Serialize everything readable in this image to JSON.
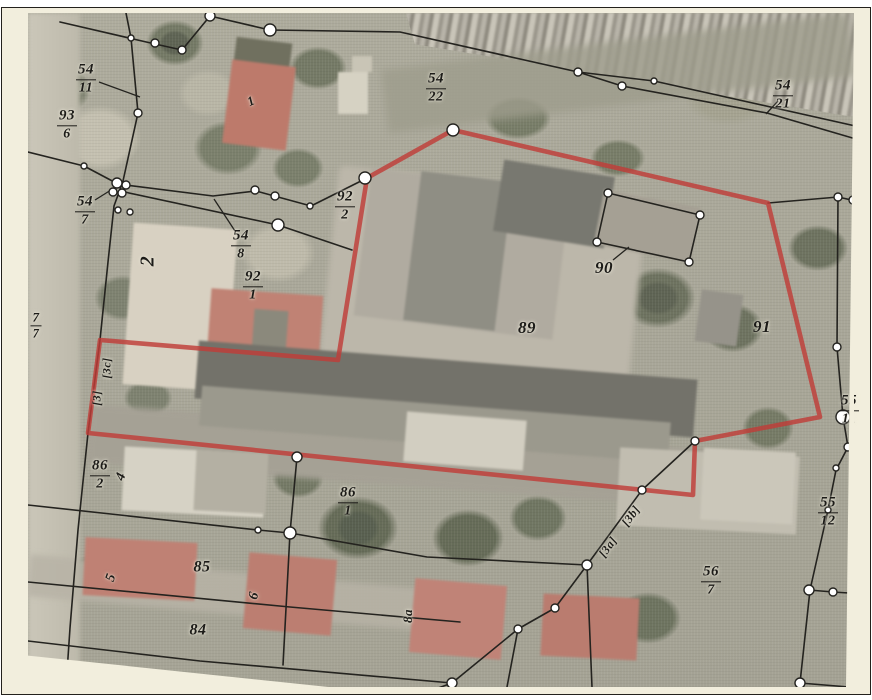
{
  "map": {
    "description_labels_note": "cadastral parcel map over aerial photo",
    "colors": {
      "paper": "#f2eedd",
      "red": "#c03d38",
      "ink": "#24231f",
      "vertex_fill": "#ffffff"
    },
    "parcel_labels": [
      {
        "x": 86,
        "y": 79,
        "num": "54",
        "den": "11"
      },
      {
        "x": 67,
        "y": 125,
        "num": "93",
        "den": "6"
      },
      {
        "x": 85,
        "y": 211,
        "num": "54",
        "den": "7"
      },
      {
        "x": 241,
        "y": 245,
        "num": "54",
        "den": "8"
      },
      {
        "x": 253,
        "y": 286,
        "num": "92",
        "den": "1"
      },
      {
        "x": 345,
        "y": 206,
        "num": "92",
        "den": "2"
      },
      {
        "x": 436,
        "y": 88,
        "num": "54",
        "den": "22"
      },
      {
        "x": 783,
        "y": 95,
        "num": "54",
        "den": "21"
      },
      {
        "x": 36,
        "y": 325,
        "num": "7",
        "den": "7",
        "size": 13
      },
      {
        "x": 849,
        "y": 410,
        "num": "55",
        "den": "11"
      },
      {
        "x": 828,
        "y": 512,
        "num": "55",
        "den": "12"
      },
      {
        "x": 711,
        "y": 581,
        "num": "56",
        "den": "7"
      },
      {
        "x": 100,
        "y": 475,
        "num": "86",
        "den": "2"
      },
      {
        "x": 348,
        "y": 502,
        "num": "86",
        "den": "1"
      },
      {
        "x": 527,
        "y": 328,
        "text": "89",
        "size": 17
      },
      {
        "x": 762,
        "y": 327,
        "text": "91",
        "size": 17
      },
      {
        "x": 604,
        "y": 268,
        "text": "90",
        "size": 17
      },
      {
        "x": 202,
        "y": 568,
        "text": "85",
        "size": 16
      },
      {
        "x": 198,
        "y": 631,
        "text": "84",
        "size": 16
      },
      {
        "x": 148,
        "y": 261,
        "text": "2",
        "size": 20,
        "rot": -90
      },
      {
        "x": 251,
        "y": 101,
        "text": "1",
        "size": 13,
        "rot": -25
      },
      {
        "x": 122,
        "y": 477,
        "text": "4",
        "size": 14,
        "rot": -70
      },
      {
        "x": 112,
        "y": 578,
        "text": "5",
        "size": 14,
        "rot": -70
      },
      {
        "x": 255,
        "y": 596,
        "text": "6",
        "size": 14,
        "rot": -75
      },
      {
        "x": 408,
        "y": 616,
        "text": "8a",
        "size": 13,
        "rot": -90
      },
      {
        "x": 107,
        "y": 368,
        "text": "[3c]",
        "size": 12,
        "rot": -90
      },
      {
        "x": 97,
        "y": 398,
        "text": "[3]",
        "size": 12,
        "rot": -90
      },
      {
        "x": 631,
        "y": 516,
        "text": "[3b]",
        "size": 12,
        "rot": -54
      },
      {
        "x": 608,
        "y": 547,
        "text": "[3a]",
        "size": 12,
        "rot": -54
      }
    ],
    "red_boundary": [
      [
        453,
        130
      ],
      [
        768,
        203
      ],
      [
        820,
        417
      ],
      [
        695,
        441
      ],
      [
        693,
        495
      ],
      [
        88,
        433
      ],
      [
        100,
        340
      ],
      [
        338,
        360
      ],
      [
        367,
        178
      ]
    ],
    "boundary_lines": [
      [
        [
          28,
          152
        ],
        [
          84,
          166
        ],
        [
          118,
          184
        ]
      ],
      [
        [
          126,
          13
        ],
        [
          131,
          38
        ],
        [
          138,
          113
        ],
        [
          123,
          181
        ],
        [
          114,
          206
        ],
        [
          108,
          262
        ],
        [
          100,
          340
        ],
        [
          88,
          433
        ],
        [
          78,
          530
        ],
        [
          70,
          628
        ],
        [
          66,
          687
        ]
      ],
      [
        [
          60,
          22
        ],
        [
          155,
          44
        ],
        [
          182,
          50
        ],
        [
          210,
          16
        ],
        [
          270,
          30
        ],
        [
          400,
          32
        ],
        [
          578,
          72
        ],
        [
          654,
          81
        ],
        [
          860,
          127
        ]
      ],
      [
        [
          578,
          72
        ],
        [
          622,
          86
        ],
        [
          767,
          113
        ],
        [
          856,
          139
        ]
      ],
      [
        [
          118,
          184
        ],
        [
          213,
          196
        ],
        [
          256,
          191
        ],
        [
          278,
          197
        ],
        [
          311,
          206
        ],
        [
          367,
          178
        ]
      ],
      [
        [
          120,
          191
        ],
        [
          278,
          225
        ],
        [
          352,
          250
        ]
      ],
      [
        [
          768,
          203
        ],
        [
          838,
          197
        ],
        [
          856,
          201
        ]
      ],
      [
        [
          838,
          197
        ],
        [
          837,
          347
        ],
        [
          843,
          417
        ],
        [
          848,
          447
        ],
        [
          836,
          470
        ],
        [
          828,
          510
        ],
        [
          810,
          590
        ],
        [
          800,
          683
        ]
      ],
      [
        [
          843,
          417
        ],
        [
          857,
          424
        ]
      ],
      [
        [
          809,
          590
        ],
        [
          833,
          592
        ],
        [
          849,
          593
        ]
      ],
      [
        [
          800,
          683
        ],
        [
          849,
          687
        ]
      ],
      [
        [
          28,
          505
        ],
        [
          258,
          530
        ],
        [
          290,
          533
        ]
      ],
      [
        [
          28,
          582
        ],
        [
          290,
          607
        ],
        [
          460,
          622
        ]
      ],
      [
        [
          28,
          641
        ],
        [
          200,
          661
        ],
        [
          452,
          683
        ]
      ],
      [
        [
          290,
          533
        ],
        [
          283,
          665
        ]
      ],
      [
        [
          430,
          691
        ],
        [
          452,
          683
        ],
        [
          518,
          629
        ],
        [
          555,
          608
        ],
        [
          587,
          565
        ],
        [
          642,
          490
        ],
        [
          695,
          441
        ]
      ],
      [
        [
          290,
          533
        ],
        [
          427,
          557
        ],
        [
          587,
          565
        ]
      ],
      [
        [
          587,
          565
        ],
        [
          592,
          687
        ]
      ],
      [
        [
          518,
          629
        ],
        [
          507,
          687
        ]
      ],
      [
        [
          297,
          457
        ],
        [
          290,
          533
        ]
      ],
      [
        [
          608,
          193
        ],
        [
          700,
          215
        ],
        [
          689,
          262
        ],
        [
          597,
          242
        ],
        [
          608,
          193
        ]
      ]
    ],
    "leader_lines": [
      [
        99,
        82,
        140,
        97
      ],
      [
        95,
        200,
        119,
        185
      ],
      [
        235,
        231,
        214,
        199
      ],
      [
        778,
        101,
        766,
        114
      ],
      [
        613,
        260,
        629,
        247
      ]
    ],
    "boundary_vertices": [
      [
        210,
        16,
        5
      ],
      [
        270,
        30,
        6
      ],
      [
        155,
        43,
        4
      ],
      [
        182,
        50,
        4
      ],
      [
        131,
        38,
        3
      ],
      [
        138,
        113,
        4
      ],
      [
        117,
        183,
        5
      ],
      [
        126,
        185,
        4
      ],
      [
        113,
        192,
        4
      ],
      [
        122,
        193,
        4
      ],
      [
        118,
        210,
        3
      ],
      [
        130,
        212,
        3
      ],
      [
        578,
        72,
        4
      ],
      [
        654,
        81,
        3
      ],
      [
        622,
        86,
        4
      ],
      [
        255,
        190,
        4
      ],
      [
        275,
        196,
        4
      ],
      [
        310,
        206,
        3
      ],
      [
        278,
        225,
        6
      ],
      [
        365,
        178,
        6
      ],
      [
        453,
        130,
        6
      ],
      [
        838,
        197,
        4
      ],
      [
        853,
        200,
        4
      ],
      [
        837,
        347,
        4
      ],
      [
        843,
        417,
        7
      ],
      [
        848,
        447,
        4
      ],
      [
        836,
        468,
        3
      ],
      [
        828,
        510,
        3
      ],
      [
        809,
        590,
        5
      ],
      [
        833,
        592,
        4
      ],
      [
        800,
        683,
        5
      ],
      [
        695,
        441,
        4
      ],
      [
        642,
        490,
        4
      ],
      [
        587,
        565,
        5
      ],
      [
        555,
        608,
        4
      ],
      [
        518,
        629,
        4
      ],
      [
        452,
        683,
        5
      ],
      [
        297,
        457,
        5
      ],
      [
        290,
        533,
        6
      ],
      [
        258,
        530,
        3
      ],
      [
        608,
        193,
        4
      ],
      [
        700,
        215,
        4
      ],
      [
        689,
        262,
        4
      ],
      [
        597,
        242,
        4
      ],
      [
        84,
        166,
        3
      ]
    ]
  }
}
